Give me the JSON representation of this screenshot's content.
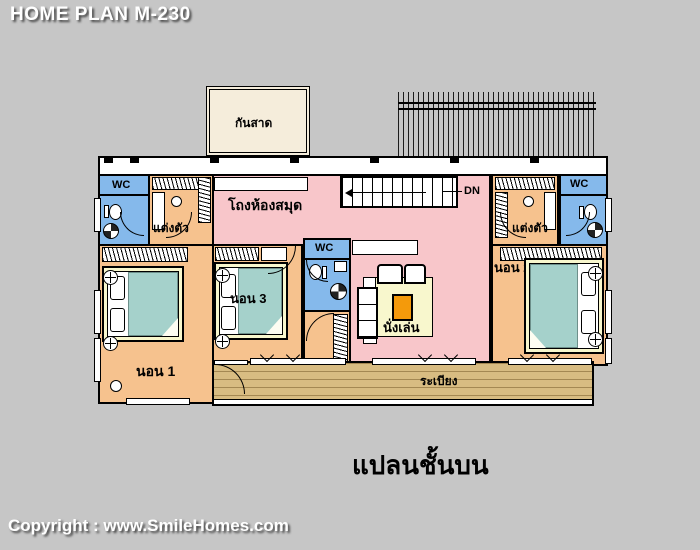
{
  "header": {
    "title": "HOME PLAN M-230"
  },
  "footer": {
    "copyright": "Copyright : www.SmileHomes.com"
  },
  "plan": {
    "caption": "แปลนชั้นบน",
    "rooms": {
      "canopy": "กันสาด",
      "wc_left": "WC",
      "dressing_left": "แต่งตัว",
      "library_hall": "โถงห้องสมุด",
      "wc_center": "WC",
      "living": "นั่งเล่น",
      "bedroom_1": "นอน 1",
      "bedroom_3": "นอน 3",
      "bedroom_2": "นอน 2",
      "dressing_right": "แต่งตัว",
      "wc_right": "WC",
      "balcony": "ระเบียง"
    },
    "stairs": {
      "direction_label": "DN"
    },
    "colors": {
      "background": "#c6c6c6",
      "room_orange": "#f6c28e",
      "hall_pink": "#f8c6ca",
      "wc_blue": "#85b9eb",
      "rug_cream": "#f8f7cd",
      "bed_teal": "#a5d1cb",
      "coffee_table_orange": "#f49a0b",
      "deck_wood": "#d8bc82",
      "canopy_cream": "#f5eddb",
      "wall_black": "#000000",
      "text_white": "#ffffff"
    }
  }
}
